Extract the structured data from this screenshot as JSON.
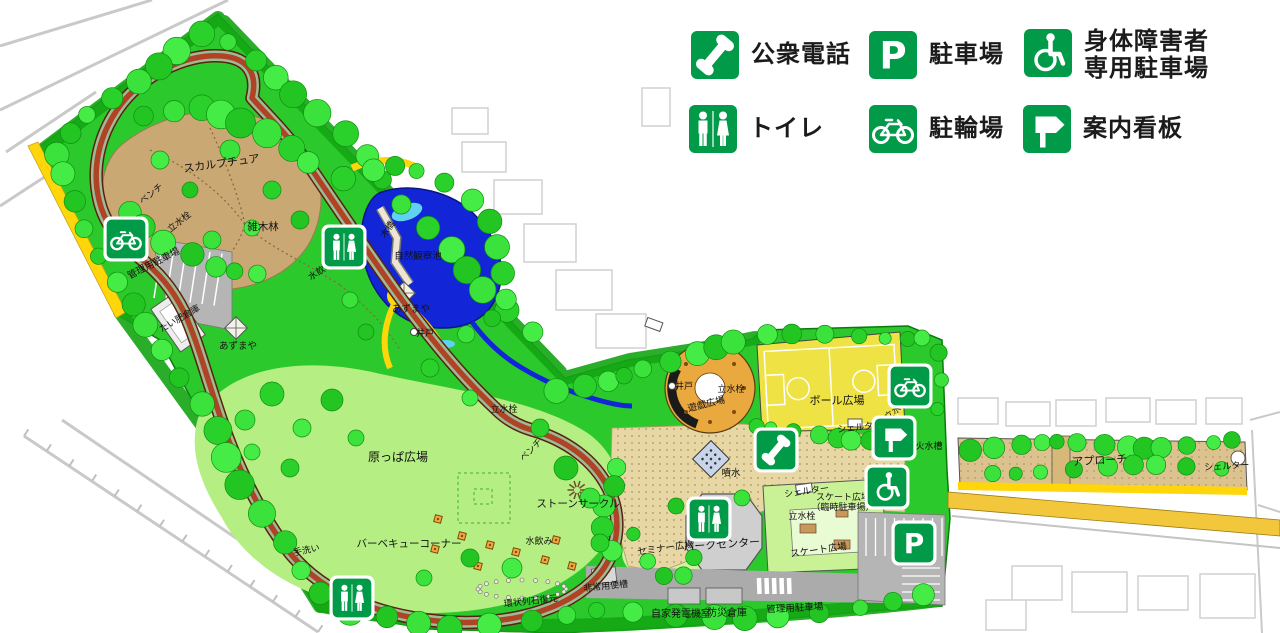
{
  "legend": {
    "icon_color": "#009A49",
    "items": [
      {
        "id": "phone",
        "icon": "phone-icon",
        "label": "公衆電話",
        "x": 690,
        "y": 30
      },
      {
        "id": "parking",
        "icon": "parking-icon",
        "label": "駐車場",
        "x": 868,
        "y": 30
      },
      {
        "id": "wheelchair",
        "icon": "wheelchair-icon",
        "label": "身体障害者\n専用駐車場",
        "x": 1023,
        "y": 28
      },
      {
        "id": "toilet",
        "icon": "toilet-icon",
        "label": "トイレ",
        "x": 688,
        "y": 104
      },
      {
        "id": "bicycle",
        "icon": "bicycle-icon",
        "label": "駐輪場",
        "x": 868,
        "y": 104
      },
      {
        "id": "signboard",
        "icon": "signboard-icon",
        "label": "案内看板",
        "x": 1022,
        "y": 104
      }
    ]
  },
  "map": {
    "labels": [
      {
        "text": "スカルプチュア",
        "x": 222,
        "y": 167,
        "rotate": -8,
        "size": 11
      },
      {
        "text": "ベンチ",
        "x": 153,
        "y": 196,
        "rotate": -38,
        "size": 9
      },
      {
        "text": "立水栓",
        "x": 181,
        "y": 224,
        "rotate": -38,
        "size": 9
      },
      {
        "text": "雑木林",
        "x": 263,
        "y": 230,
        "rotate": 0,
        "size": 10.5
      },
      {
        "text": "管理用駐車場",
        "x": 155,
        "y": 266,
        "rotate": -27,
        "size": 9.5
      },
      {
        "text": "たい肥倉庫",
        "x": 181,
        "y": 321,
        "rotate": -30,
        "size": 9
      },
      {
        "text": "水飲み",
        "x": 322,
        "y": 273,
        "rotate": -33,
        "size": 9
      },
      {
        "text": "木橋",
        "x": 390,
        "y": 231,
        "rotate": -55,
        "size": 9
      },
      {
        "text": "自然観察池",
        "x": 418,
        "y": 259,
        "rotate": 0,
        "size": 9.5
      },
      {
        "text": "あずまや",
        "x": 411,
        "y": 312,
        "rotate": 0,
        "size": 9.5
      },
      {
        "text": "井戸",
        "x": 425,
        "y": 336,
        "rotate": 0,
        "size": 9
      },
      {
        "text": "あずまや",
        "x": 238,
        "y": 349,
        "rotate": 0,
        "size": 9.5
      },
      {
        "text": "原っぱ広場",
        "x": 398,
        "y": 461,
        "rotate": 0,
        "size": 12
      },
      {
        "text": "ベンチ",
        "x": 533,
        "y": 452,
        "rotate": -45,
        "size": 9
      },
      {
        "text": "立水栓",
        "x": 504,
        "y": 412,
        "rotate": 0,
        "size": 9
      },
      {
        "text": "ストーンサークル",
        "x": 578,
        "y": 507,
        "rotate": 0,
        "size": 10.5
      },
      {
        "text": "水飲み",
        "x": 539,
        "y": 544,
        "rotate": 0,
        "size": 9
      },
      {
        "text": "バーベキューコーナー",
        "x": 409,
        "y": 547,
        "rotate": 0,
        "size": 10.5
      },
      {
        "text": "手洗い",
        "x": 307,
        "y": 553,
        "rotate": -12,
        "size": 9
      },
      {
        "text": "非常用便槽",
        "x": 606,
        "y": 589,
        "rotate": -6,
        "size": 9
      },
      {
        "text": "環状列石復元",
        "x": 531,
        "y": 604,
        "rotate": -6,
        "size": 9
      },
      {
        "text": "自家発電機室",
        "x": 681,
        "y": 617,
        "rotate": 0,
        "size": 10
      },
      {
        "text": "防災倉庫",
        "x": 727,
        "y": 616,
        "rotate": 0,
        "size": 10
      },
      {
        "text": "管理用駐車場",
        "x": 795,
        "y": 611,
        "rotate": -3,
        "size": 9.5
      },
      {
        "text": "セミナー広場",
        "x": 666,
        "y": 551,
        "rotate": -8,
        "size": 9.5
      },
      {
        "text": "パークセンター",
        "x": 722,
        "y": 548,
        "rotate": -4,
        "size": 11
      },
      {
        "text": "スケート広場",
        "x": 819,
        "y": 553,
        "rotate": -8,
        "size": 9.5
      },
      {
        "lines": [
          "スケート広場",
          "（臨時駐車場）"
        ],
        "x": 843,
        "y": 500,
        "rotate": 0,
        "size": 9
      },
      {
        "text": "立水栓",
        "x": 802,
        "y": 519,
        "rotate": 0,
        "size": 9
      },
      {
        "text": "シェルター",
        "x": 807,
        "y": 494,
        "rotate": -8,
        "size": 9
      },
      {
        "text": "シェルター",
        "x": 860,
        "y": 430,
        "rotate": -6,
        "size": 9
      },
      {
        "text": "ボール広場",
        "x": 837,
        "y": 404,
        "rotate": 0,
        "size": 11
      },
      {
        "text": "遊戯広場",
        "x": 707,
        "y": 407,
        "rotate": -14,
        "size": 9.5
      },
      {
        "text": "井戸",
        "x": 684,
        "y": 389,
        "rotate": 0,
        "size": 9
      },
      {
        "text": "立水栓",
        "x": 731,
        "y": 392,
        "rotate": 0,
        "size": 9
      },
      {
        "text": "立水栓",
        "x": 898,
        "y": 412,
        "rotate": -38,
        "size": 9
      },
      {
        "text": "火水槽",
        "x": 929,
        "y": 449,
        "rotate": 0,
        "size": 9
      },
      {
        "text": "噴水",
        "x": 731,
        "y": 476,
        "rotate": 0,
        "size": 9.5
      },
      {
        "text": "アプローチ",
        "x": 1100,
        "y": 464,
        "rotate": -3,
        "size": 11
      },
      {
        "text": "シェルター",
        "x": 1227,
        "y": 469,
        "rotate": -3,
        "size": 9
      }
    ],
    "icons": [
      {
        "type": "bicycle",
        "x": 126,
        "y": 239
      },
      {
        "type": "toilet",
        "x": 344,
        "y": 247
      },
      {
        "type": "toilet",
        "x": 709,
        "y": 519
      },
      {
        "type": "toilet",
        "x": 352,
        "y": 598
      },
      {
        "type": "phone",
        "x": 776,
        "y": 450
      },
      {
        "type": "bicycle",
        "x": 910,
        "y": 386
      },
      {
        "type": "signboard",
        "x": 894,
        "y": 438
      },
      {
        "type": "wheelchair",
        "x": 887,
        "y": 487
      },
      {
        "type": "parking",
        "x": 914,
        "y": 543
      }
    ],
    "colors": {
      "sign_green": "#009A49",
      "park_green": "#2CC92C",
      "lawn_green": "#B5EE83",
      "course_red": "#B04226",
      "pond_blue": "#1226D8",
      "path_yellow": "#FFD60A",
      "court_yellow": "#EFE244",
      "plaza_tan": "#E6D7A5",
      "label_black": "#111111"
    }
  }
}
